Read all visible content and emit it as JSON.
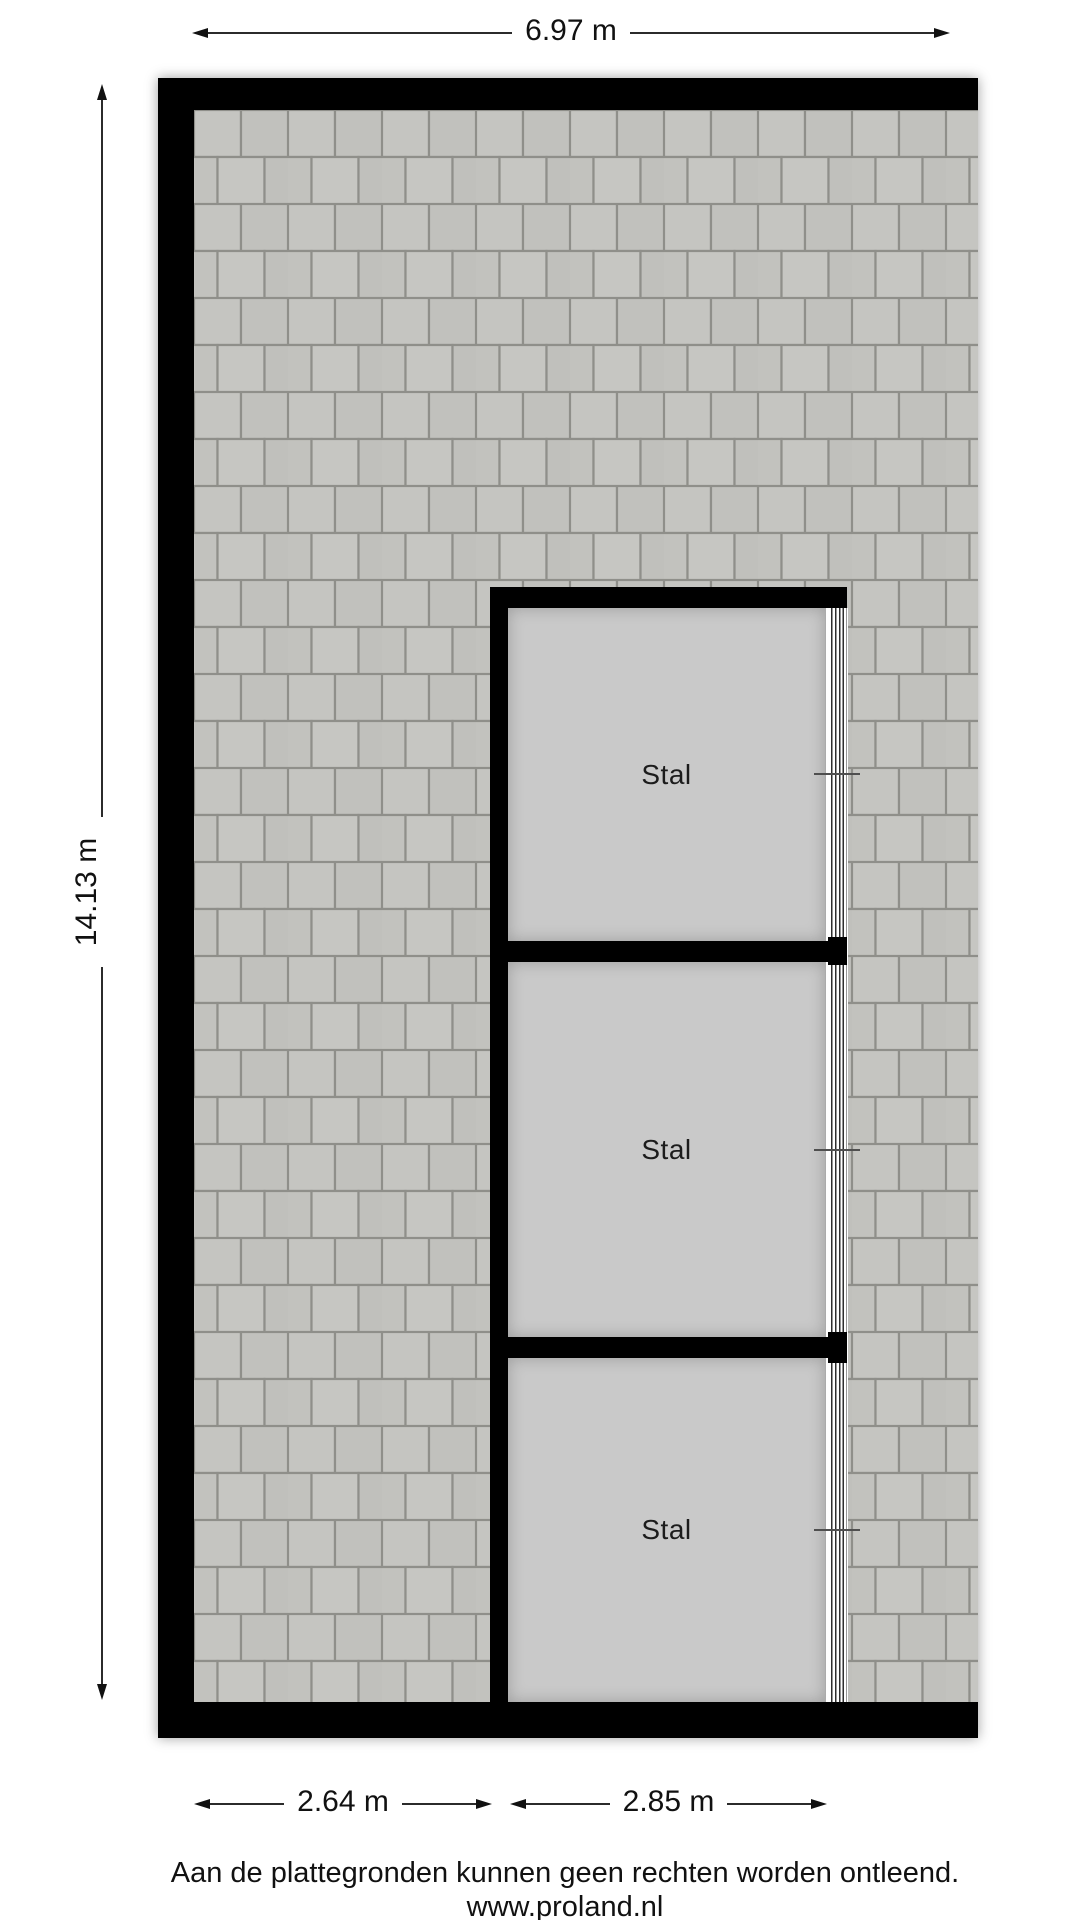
{
  "floorplan": {
    "rooms": [
      {
        "label": "Stal"
      },
      {
        "label": "Stal"
      },
      {
        "label": "Stal"
      }
    ]
  },
  "dimensions": {
    "top_width": "6.97 m",
    "left_height": "14.13 m",
    "bottom_left_width": "2.64 m",
    "bottom_right_width": "2.85 m"
  },
  "footer": {
    "disclaimer": "Aan de plattegronden kunnen geen rechten worden ontleend.",
    "website": "www.proland.nl"
  },
  "colors": {
    "wall": "#000000",
    "room_fill": "#c9c9c9",
    "tile_fill": "#c3c3bf",
    "tile_gap": "#8f8f8a",
    "window_frame": "#2e2e2e",
    "text": "#111111"
  }
}
